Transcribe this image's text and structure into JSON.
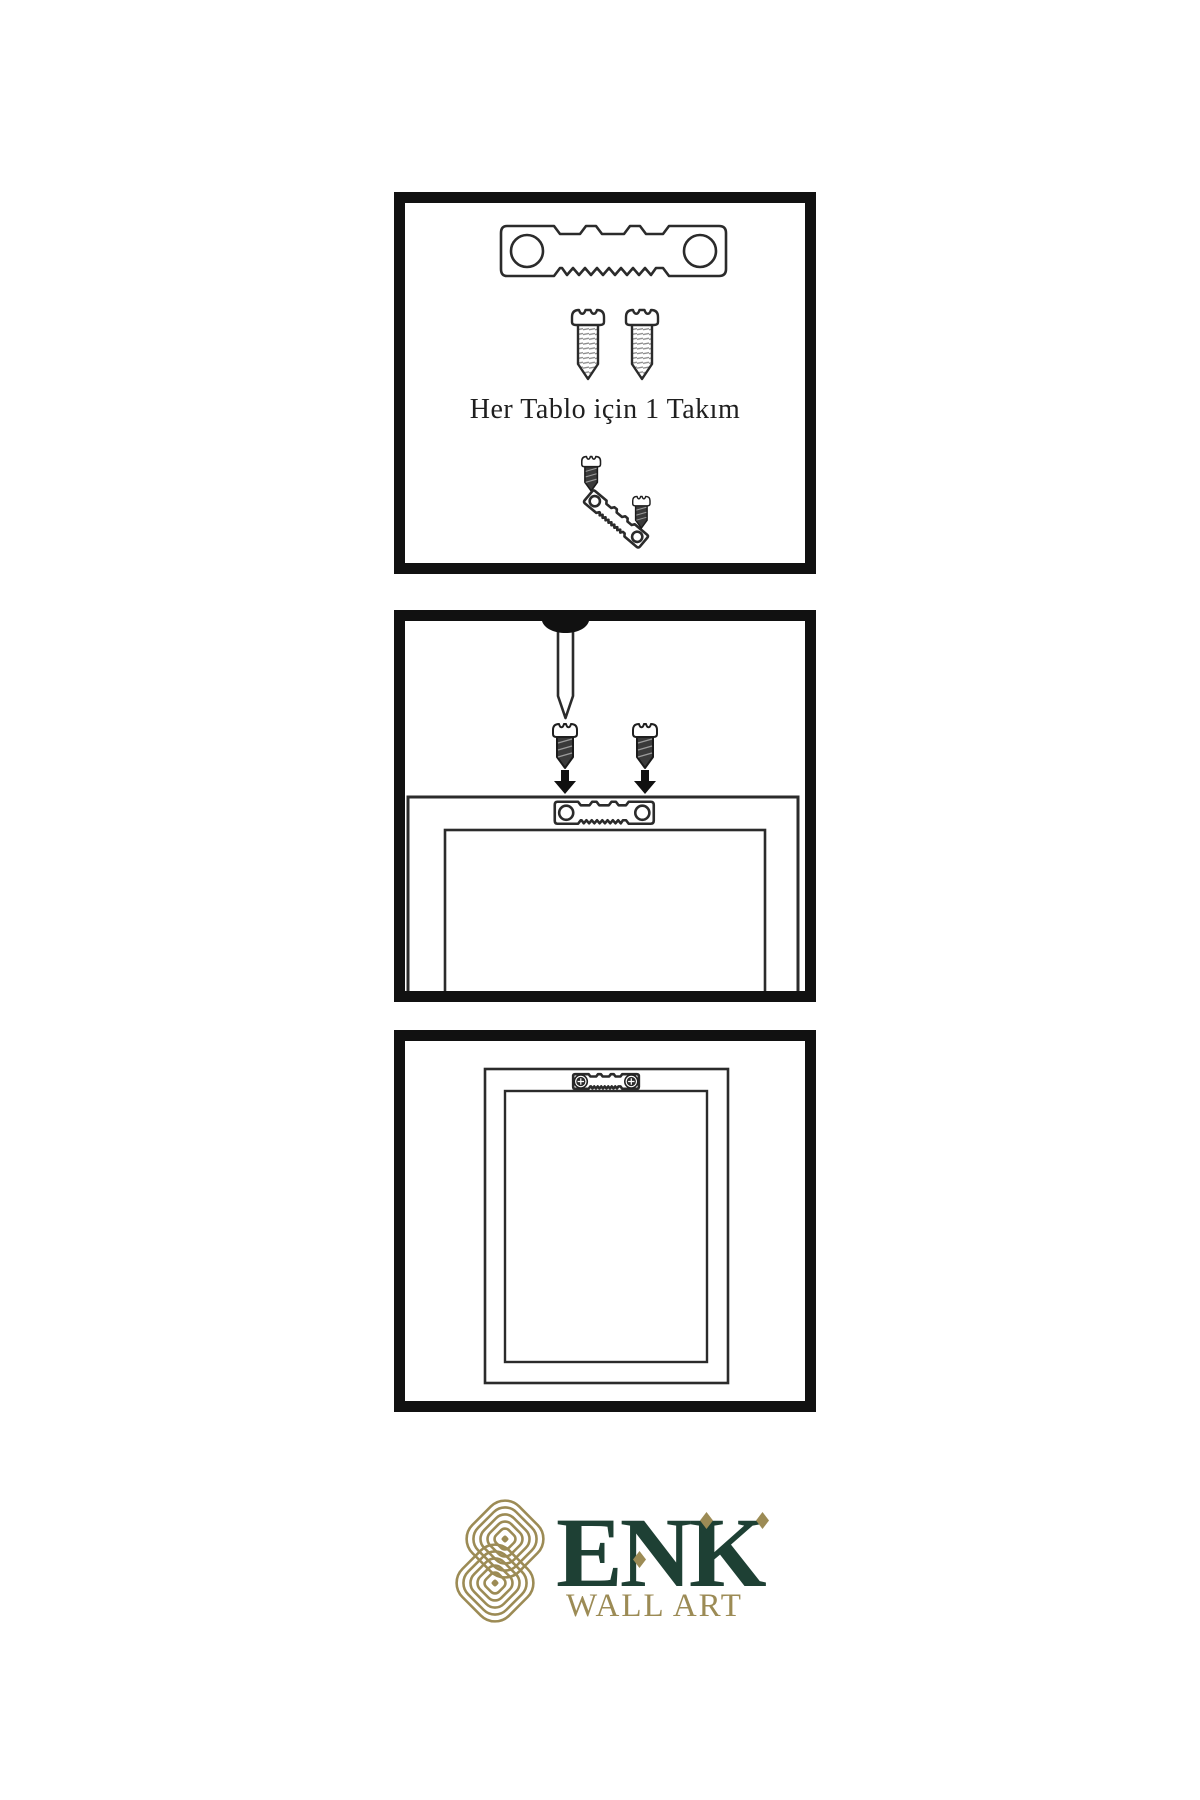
{
  "page": {
    "background": "#ffffff",
    "description_icons": [
      "sawtooth-hanger-icon",
      "screw-icon",
      "nail-icon",
      "down-arrow-icon",
      "frame-back-icon"
    ]
  },
  "colors": {
    "panel_border": "#111111",
    "line_art": "#2b2b2b",
    "screw_dark_fill": "#3a3a3a",
    "brand_gold": "#9c8b55",
    "brand_green": "#1e4034"
  },
  "steps": [
    {
      "caption": "Her Tablo için 1 Takım",
      "icons": [
        "sawtooth-hanger-icon",
        "screw-icon",
        "screw-icon",
        "small-screw-icon",
        "tilted-sawtooth-hanger-icon",
        "small-screw-icon"
      ]
    },
    {
      "caption": "",
      "icons": [
        "nail-icon",
        "dark-screw-icon",
        "dark-screw-icon",
        "down-arrow-icon",
        "down-arrow-icon",
        "frame-back-icon",
        "sawtooth-hanger-icon"
      ]
    },
    {
      "caption": "",
      "icons": [
        "frame-back-icon",
        "mounted-sawtooth-hanger-icon",
        "screw-head-icon",
        "screw-head-icon"
      ]
    }
  ],
  "logo": {
    "brand": "ENK",
    "tagline": "WALL ART",
    "icon": "interlaced-knot-icon",
    "brand_color": "#1e4034",
    "accent_color": "#9c8b55"
  }
}
